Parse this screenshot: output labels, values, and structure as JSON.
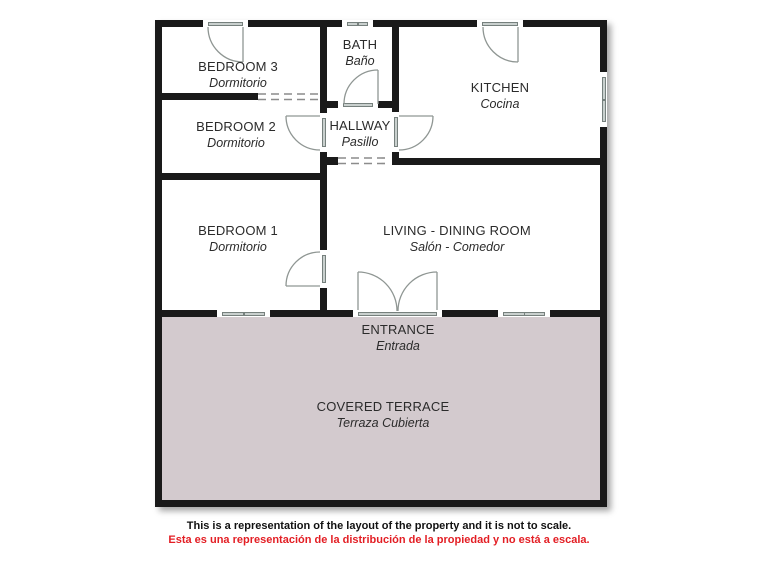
{
  "rooms": [
    {
      "id": "bedroom3",
      "name": "BEDROOM 3",
      "subtitle": "Dormitorio"
    },
    {
      "id": "bath",
      "name": "BATH",
      "subtitle": "Baño"
    },
    {
      "id": "kitchen",
      "name": "KITCHEN",
      "subtitle": "Cocina"
    },
    {
      "id": "bedroom2",
      "name": "BEDROOM 2",
      "subtitle": "Dormitorio"
    },
    {
      "id": "hallway",
      "name": "HALLWAY",
      "subtitle": "Pasillo"
    },
    {
      "id": "bedroom1",
      "name": "BEDROOM 1",
      "subtitle": "Dormitorio"
    },
    {
      "id": "living",
      "name": "LIVING - DINING ROOM",
      "subtitle": "Salón - Comedor"
    },
    {
      "id": "entrance",
      "name": "ENTRANCE",
      "subtitle": "Entrada"
    },
    {
      "id": "terrace",
      "name": "COVERED TERRACE",
      "subtitle": "Terraza Cubierta"
    }
  ],
  "disclaimer": {
    "en": "This is a representation of the layout of the property and it is not to scale.",
    "es": "Esta es una representación de la distribución de la propiedad y no está a escala."
  },
  "colors": {
    "wall": "#1a1a1a",
    "terrace_fill": "#d3cace",
    "window_fill": "#c9d0ce",
    "door_stroke": "#8f9693",
    "disclaimer_red": "#e31e24"
  }
}
